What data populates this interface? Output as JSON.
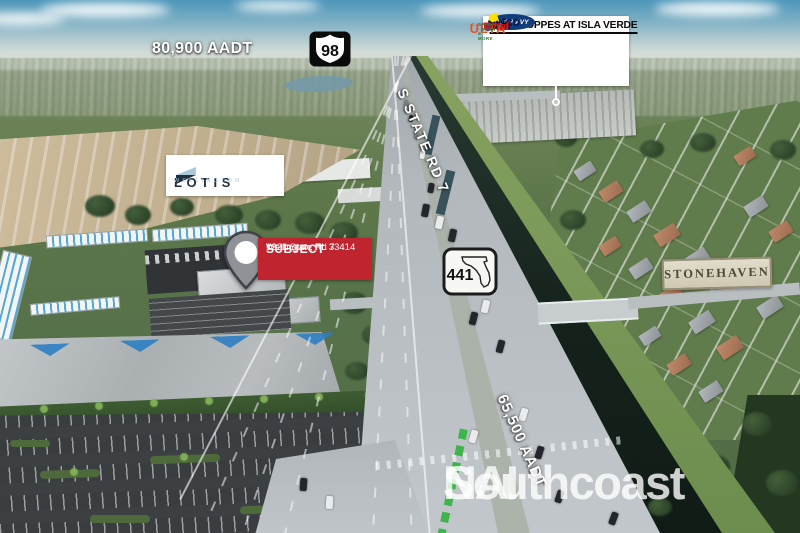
{
  "overlays": {
    "aadt_top": "80,900 AADT",
    "aadt_road": "65,500 AADT",
    "road_label": "S STATE RD 7",
    "us_route_98": "98",
    "fl_route_441": "441",
    "shoppes_panel": {
      "title": "THE SHOPPES AT ISLA VERDE",
      "old_navy": "OLD NAVY",
      "petco": "petco",
      "best_buy_1": "BEST",
      "best_buy_2": "BUY",
      "ulta": "ULTA",
      "ulta_sub": "BEAUTY",
      "total_wine_1": "Total",
      "total_wine_2": "Wine",
      "total_wine_sub": "SPIRITS · BEER & MORE"
    },
    "lotis": {
      "name": "LOTIS",
      "city": "WELLINGTON"
    },
    "subject": {
      "label": "SUBJECT",
      "address_line1": "1221 State Rd 7",
      "address_line2": "Wellington, FL 33414"
    },
    "stonehaven": "STONEHAVEN",
    "watermark": {
      "brand": "NAI",
      "suffix": "Southcoast"
    }
  },
  "colors": {
    "banner_red": "#c0252f",
    "old_navy_blue": "#123d7a",
    "petco_navy": "#001952",
    "best_buy_yellow": "#ffe000",
    "ulta_orange": "#f04e23",
    "total_wine_red": "#c4161c",
    "total_wine_green": "#2e7d32",
    "lotis_navy": "#202f40",
    "lotis_blue": "#a9c8da",
    "stonehaven_text": "#4b4934"
  }
}
